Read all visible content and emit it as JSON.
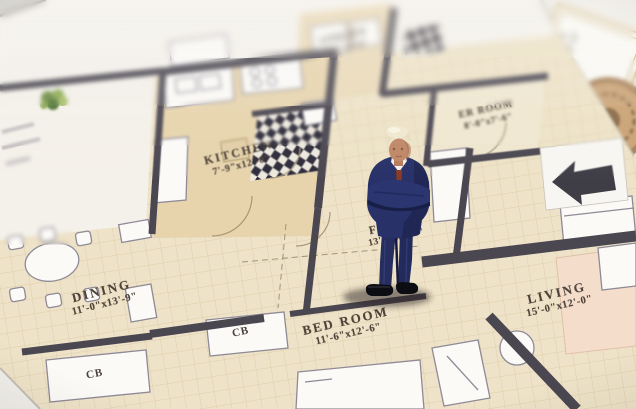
{
  "floor_plan": {
    "rooms": [
      {
        "name": "KITCHEN",
        "dimensions": "7'-9\"x12'-0\""
      },
      {
        "name": "DINING",
        "dimensions": "11'-0\"x13'-9\""
      },
      {
        "name": "BED ROOM",
        "dimensions": "11'-6\"x12'-6\""
      },
      {
        "name": "LIVING",
        "dimensions": "15'-0\"x12'-0\""
      },
      {
        "name": "FOYER",
        "dimensions": "13'-0\"x5'-6\""
      },
      {
        "name": "UTILITY",
        "dimensions": "5'-6\"x9'-0\""
      },
      {
        "name": "ER ROOM",
        "dimensions": "8'-0\"x7'-6\""
      },
      {
        "name": "Toilet",
        "dimensions": "5'-8\"x7'-5\""
      }
    ],
    "cabinets": [
      "CB",
      "CB"
    ]
  },
  "icons": {
    "entry_arrow": "left-arrow",
    "plant": "plant-cluster",
    "ornament": "round-medallion",
    "figurine": "businessman-miniature"
  },
  "colors": {
    "paper": "#f5f2ec",
    "plan_tan": "#e7d4ad",
    "room_cream": "#eee3c8",
    "wall": "#4b4751",
    "label_text": "#50443a",
    "checker_dark": "#2e2c3a",
    "rug_peach": "#f5ddcb",
    "suit_navy": "#273066",
    "shoe_black": "#0c0d12",
    "hair_blond": "#ece2c6",
    "skin": "#bf8666"
  }
}
